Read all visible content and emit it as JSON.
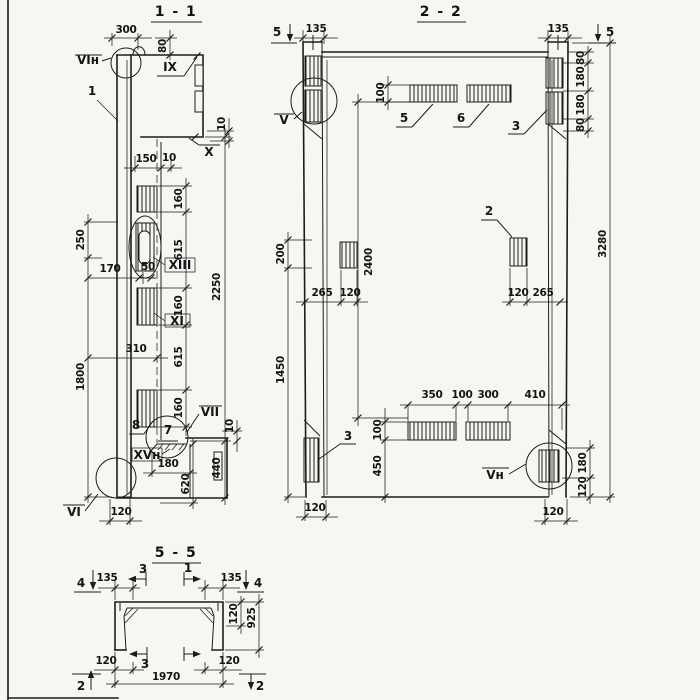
{
  "sheet": {
    "background": "#f7f6f2",
    "ink": "#1c1c1c"
  },
  "s11": {
    "title": "1 - 1",
    "dims": {
      "w300": "300",
      "h80": "80",
      "w150": "150",
      "w10": "10",
      "h10_top": "10",
      "h250": "250",
      "w170": "170",
      "w50": "50",
      "h160a": "160",
      "h615a": "615",
      "h160b": "160",
      "h615b": "615",
      "h160c": "160",
      "h2250": "2250",
      "w310": "310",
      "h1800": "1800",
      "w180": "180",
      "h620": "620",
      "h440": "440",
      "h10_shelf": "10",
      "w120": "120"
    },
    "labels": {
      "detail_vi_n": "VIн",
      "callout_1": "1",
      "ref_ix": "IX",
      "ref_x": "X",
      "ref_xiii": "XIII",
      "ref_xi": "XI",
      "callout_8": "8",
      "callout_7": "7",
      "ref_vii": "VII",
      "ref_xv_n": "XVн",
      "detail_vi": "VI"
    }
  },
  "s22": {
    "title": "2 - 2",
    "dims": {
      "w135_l": "135",
      "w135_r": "135",
      "h100_top": "100",
      "h80a": "80",
      "h180a": "180",
      "h180b": "180",
      "h80b": "80",
      "h3280": "3280",
      "h200": "200",
      "h1450": "1450",
      "h2400": "2400",
      "w265_l": "265",
      "w120_l": "120",
      "w120_r": "120",
      "w265_r": "265",
      "w350": "350",
      "w100": "100",
      "w300": "300",
      "w410": "410",
      "h100_bot": "100",
      "h450": "450",
      "h180_r": "180",
      "h120_r": "120",
      "w120_bl": "120",
      "w120_br": "120"
    },
    "labels": {
      "marker_5_l": "5",
      "marker_5_r": "5",
      "detail_v": "V",
      "callout_5": "5",
      "callout_6": "6",
      "callout_3_top": "3",
      "callout_2": "2",
      "callout_3_bot": "3",
      "detail_v_n": "Vн"
    }
  },
  "s55": {
    "title": "5 - 5",
    "dims": {
      "w135_l": "135",
      "w135_r": "135",
      "h120": "120",
      "h925": "925",
      "w120_bl": "120",
      "w120_br": "120",
      "w1970": "1970"
    },
    "labels": {
      "marker_4_l": "4",
      "marker_4_r": "4",
      "marker_3_top": "3",
      "marker_1_top": "1",
      "marker_3_bot": "3",
      "marker_2_l": "2",
      "marker_2_r": "2"
    }
  }
}
